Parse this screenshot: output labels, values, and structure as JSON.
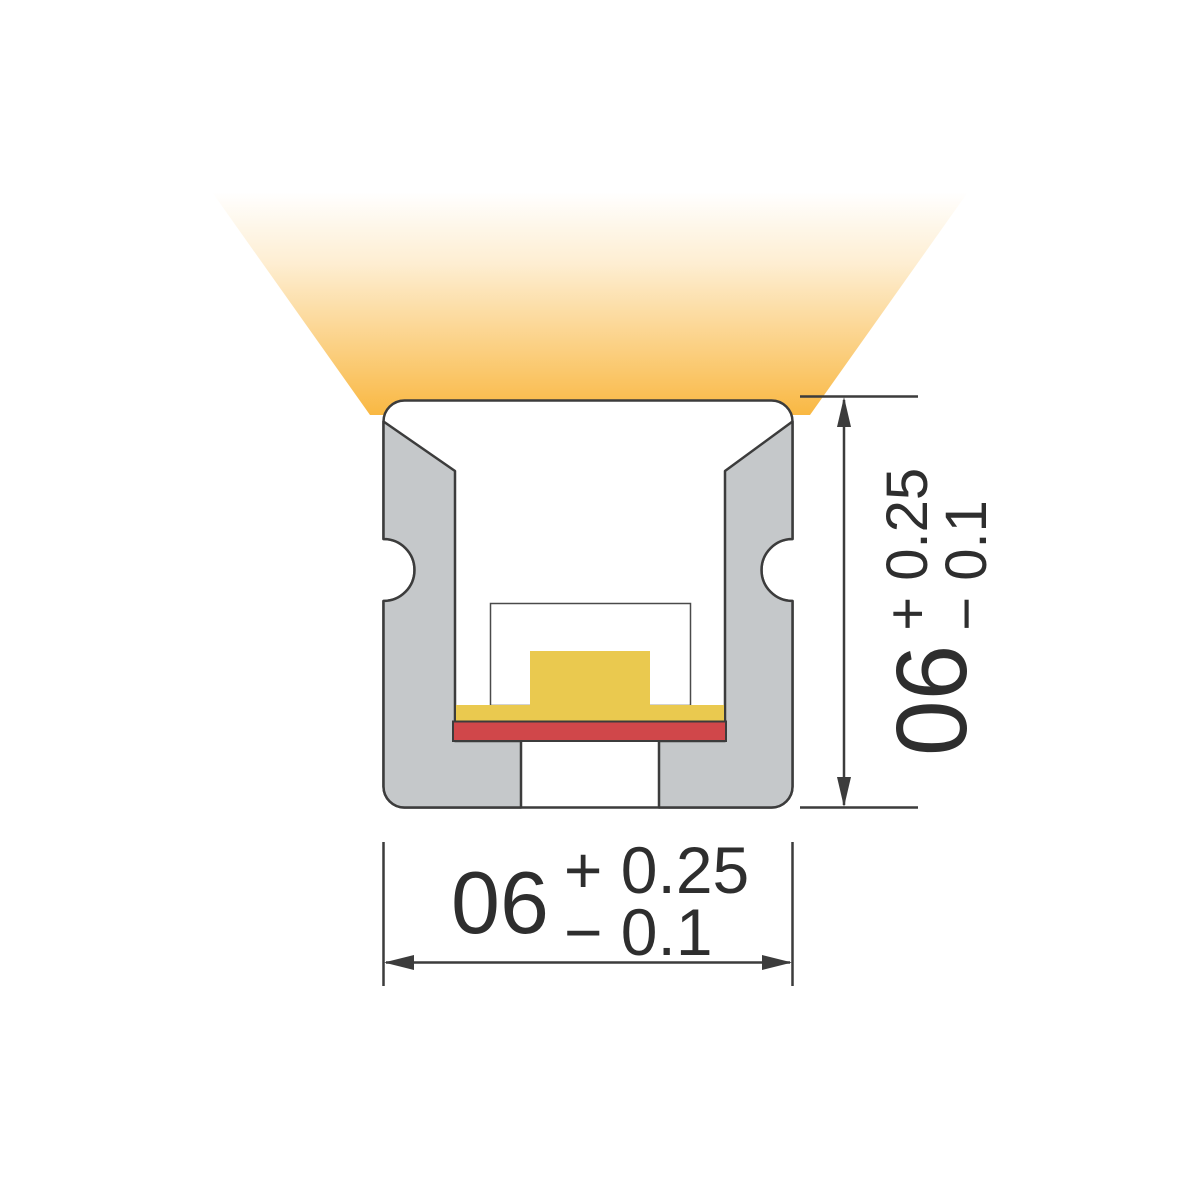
{
  "colors": {
    "light_beam": "#F9B843",
    "profile_gray": "#C5C8CA",
    "outline": "#3C3C3C",
    "lens_outline": "#4A4A4A",
    "led_yellow": "#EAC94F",
    "pcb_red": "#D0474A",
    "text": "#2E2E2E",
    "background": "#FFFFFF"
  },
  "dimensions": {
    "width": {
      "value": "06",
      "tolerance_upper": "+ 0.25",
      "tolerance_lower": "− 0.1"
    },
    "height": {
      "value": "06",
      "tolerance_upper": "+ 0.25",
      "tolerance_lower": "− 0.1"
    }
  }
}
